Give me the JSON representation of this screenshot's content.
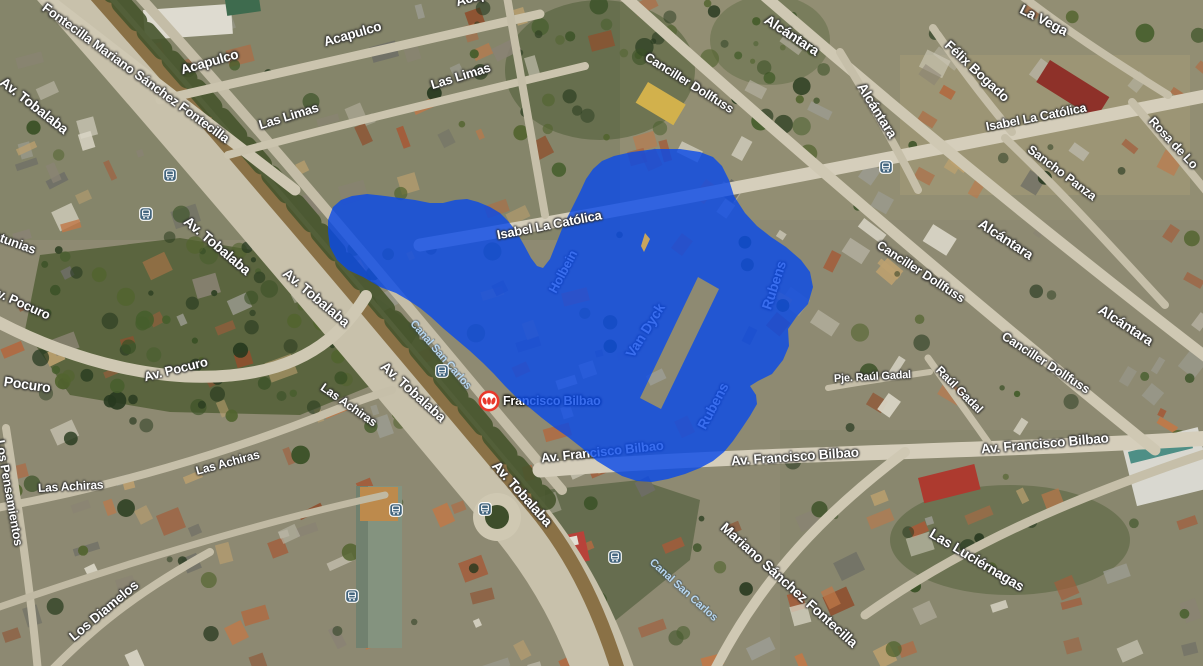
{
  "app": {
    "view": "satellite-map",
    "description": "Aerial map view with a blue highlighted area over the Francisco Bilbao / Av. Tobalaba district"
  },
  "colors": {
    "region_fill": "#0848ea",
    "region_opacity": 0.8,
    "gap_sliver_fill": "#c8a55e",
    "street_label": "#ffffff",
    "water_label": "#b7d6ef",
    "bus_icon_bg": "#43657e",
    "metro_red": "#e8392b",
    "ground_base": "#8e8a72",
    "road": "#d5cebb"
  },
  "metro_station": {
    "label": "Francisco Bilbao",
    "x": 489,
    "y": 401
  },
  "bus_stops": [
    {
      "x": 170,
      "y": 175
    },
    {
      "x": 146,
      "y": 214
    },
    {
      "x": 442,
      "y": 371
    },
    {
      "x": 396,
      "y": 510
    },
    {
      "x": 485,
      "y": 509
    },
    {
      "x": 615,
      "y": 557
    },
    {
      "x": 352,
      "y": 596
    },
    {
      "x": 886,
      "y": 167
    }
  ],
  "region_overlay": {
    "name": "highlighted-area",
    "fill": "#0848ea",
    "opacity": 0.8,
    "outer": [
      [
        328,
        232
      ],
      [
        328,
        220
      ],
      [
        333,
        207
      ],
      [
        341,
        200
      ],
      [
        352,
        196
      ],
      [
        367,
        194
      ],
      [
        385,
        196
      ],
      [
        400,
        198
      ],
      [
        415,
        200
      ],
      [
        430,
        203
      ],
      [
        443,
        203
      ],
      [
        455,
        200
      ],
      [
        467,
        199
      ],
      [
        478,
        202
      ],
      [
        490,
        207
      ],
      [
        500,
        213
      ],
      [
        508,
        221
      ],
      [
        516,
        231
      ],
      [
        524,
        245
      ],
      [
        531,
        258
      ],
      [
        537,
        266
      ],
      [
        543,
        268
      ],
      [
        550,
        259
      ],
      [
        556,
        244
      ],
      [
        562,
        229
      ],
      [
        568,
        216
      ],
      [
        574,
        204
      ],
      [
        580,
        192
      ],
      [
        586,
        179
      ],
      [
        593,
        169
      ],
      [
        602,
        161
      ],
      [
        614,
        156
      ],
      [
        632,
        152
      ],
      [
        655,
        149
      ],
      [
        680,
        149
      ],
      [
        700,
        152
      ],
      [
        713,
        157
      ],
      [
        722,
        166
      ],
      [
        729,
        180
      ],
      [
        734,
        196
      ],
      [
        745,
        213
      ],
      [
        757,
        226
      ],
      [
        771,
        237
      ],
      [
        786,
        247
      ],
      [
        801,
        260
      ],
      [
        810,
        272
      ],
      [
        813,
        287
      ],
      [
        808,
        304
      ],
      [
        797,
        316
      ],
      [
        788,
        329
      ],
      [
        789,
        346
      ],
      [
        783,
        360
      ],
      [
        772,
        374
      ],
      [
        758,
        381
      ],
      [
        750,
        386
      ],
      [
        756,
        395
      ],
      [
        757,
        404
      ],
      [
        750,
        416
      ],
      [
        742,
        428
      ],
      [
        733,
        441
      ],
      [
        724,
        452
      ],
      [
        713,
        461
      ],
      [
        700,
        468
      ],
      [
        685,
        474
      ],
      [
        668,
        479
      ],
      [
        652,
        482
      ],
      [
        637,
        481
      ],
      [
        622,
        476
      ],
      [
        610,
        469
      ],
      [
        597,
        461
      ],
      [
        582,
        448
      ],
      [
        568,
        437
      ],
      [
        555,
        428
      ],
      [
        542,
        418
      ],
      [
        530,
        408
      ],
      [
        517,
        398
      ],
      [
        505,
        386
      ],
      [
        494,
        374
      ],
      [
        483,
        363
      ],
      [
        470,
        351
      ],
      [
        457,
        340
      ],
      [
        444,
        329
      ],
      [
        431,
        317
      ],
      [
        420,
        308
      ],
      [
        408,
        300
      ],
      [
        396,
        293
      ],
      [
        380,
        287
      ],
      [
        363,
        277
      ],
      [
        348,
        270
      ],
      [
        337,
        260
      ],
      [
        330,
        247
      ]
    ],
    "hole": [
      [
        698,
        277
      ],
      [
        719,
        289
      ],
      [
        661,
        409
      ],
      [
        640,
        398
      ]
    ],
    "gap_sliver": [
      [
        645,
        233
      ],
      [
        650,
        239
      ],
      [
        644,
        252
      ],
      [
        641,
        246
      ]
    ]
  },
  "map_labels": [
    {
      "id": "fontecilla-top",
      "text": "Fontecilla Mariano Sánchez Fontecilla",
      "x": 44,
      "y": 6,
      "rot": 36,
      "fs": 13,
      "style": "street",
      "layer": "over"
    },
    {
      "id": "av-tobalaba-1",
      "text": "Av. Tobalaba",
      "x": 2,
      "y": 80,
      "rot": 38,
      "fs": 14,
      "style": "street",
      "layer": "over"
    },
    {
      "id": "acapulco-1",
      "text": "Acapulco",
      "x": 181,
      "y": 70,
      "rot": -16,
      "fs": 13.5,
      "style": "street",
      "layer": "over"
    },
    {
      "id": "acapulco-2",
      "text": "Acapulco",
      "x": 324,
      "y": 42,
      "rot": -16,
      "fs": 13.5,
      "style": "street",
      "layer": "over"
    },
    {
      "id": "acapulco-3",
      "text": "Acapulco",
      "x": 456,
      "y": 2,
      "rot": -16,
      "fs": 13.5,
      "style": "street",
      "layer": "over"
    },
    {
      "id": "las-limas-1",
      "text": "Las Limas",
      "x": 259,
      "y": 125,
      "rot": -17,
      "fs": 13,
      "style": "street",
      "layer": "over"
    },
    {
      "id": "las-limas-2",
      "text": "Las Limas",
      "x": 431,
      "y": 85,
      "rot": -17,
      "fs": 13,
      "style": "street",
      "layer": "over"
    },
    {
      "id": "canciller-dollfuss-1",
      "text": "Canciller Dollfuss",
      "x": 646,
      "y": 56,
      "rot": 32,
      "fs": 12.5,
      "style": "street",
      "layer": "over"
    },
    {
      "id": "alcantara-1",
      "text": "Alcántara",
      "x": 766,
      "y": 18,
      "rot": 33,
      "fs": 14,
      "style": "street",
      "layer": "over"
    },
    {
      "id": "alcantara-2",
      "text": "Alcántara",
      "x": 861,
      "y": 84,
      "rot": 58,
      "fs": 14,
      "style": "street",
      "layer": "over"
    },
    {
      "id": "la-vega",
      "text": "La Vega",
      "x": 1021,
      "y": 8,
      "rot": 27,
      "fs": 14,
      "style": "street",
      "layer": "over"
    },
    {
      "id": "felix-bogado",
      "text": "Félix Bogado",
      "x": 947,
      "y": 43,
      "rot": 43,
      "fs": 13.5,
      "style": "street",
      "layer": "over"
    },
    {
      "id": "isabel-la-catolica-1",
      "text": "Isabel La Católica",
      "x": 986,
      "y": 127,
      "rot": -11,
      "fs": 12.5,
      "style": "street",
      "layer": "over"
    },
    {
      "id": "sancho-panza",
      "text": "Sancho Panza",
      "x": 1029,
      "y": 148,
      "rot": 37,
      "fs": 12.5,
      "style": "street",
      "layer": "over"
    },
    {
      "id": "rosa-de-lo",
      "text": "Rosa de Lo",
      "x": 1151,
      "y": 119,
      "rot": 47,
      "fs": 12.5,
      "style": "street",
      "layer": "over"
    },
    {
      "id": "av-tobalaba-2",
      "text": "Av. Tobalaba",
      "x": 186,
      "y": 219,
      "rot": 40,
      "fs": 14,
      "style": "street",
      "layer": "over"
    },
    {
      "id": "av-tobalaba-3",
      "text": "Av. Tobalaba",
      "x": 285,
      "y": 271,
      "rot": 40,
      "fs": 14,
      "style": "street",
      "layer": "over"
    },
    {
      "id": "petunias",
      "text": "Petunias",
      "x": -14,
      "y": 232,
      "rot": 20,
      "fs": 13,
      "style": "street",
      "layer": "over"
    },
    {
      "id": "av-pocuro-1",
      "text": "Av. Pocuro",
      "x": -10,
      "y": 289,
      "rot": 24,
      "fs": 13,
      "style": "street",
      "layer": "over"
    },
    {
      "id": "pocuro",
      "text": "Pocuro",
      "x": 4,
      "y": 381,
      "rot": 8,
      "fs": 14,
      "style": "street",
      "layer": "over"
    },
    {
      "id": "av-pocuro-2",
      "text": "Av. Pocuro",
      "x": 144,
      "y": 377,
      "rot": -14,
      "fs": 13,
      "style": "street",
      "layer": "over"
    },
    {
      "id": "las-achiras-1",
      "text": "Las Achiras",
      "x": 322,
      "y": 386,
      "rot": 35,
      "fs": 12,
      "style": "street",
      "layer": "over"
    },
    {
      "id": "av-tobalaba-4",
      "text": "Av. Tobalaba",
      "x": 383,
      "y": 364,
      "rot": 42,
      "fs": 14,
      "style": "street",
      "layer": "over"
    },
    {
      "id": "av-tobalaba-5",
      "text": "Av. Tobalaba",
      "x": 495,
      "y": 463,
      "rot": 48,
      "fs": 14,
      "style": "street",
      "layer": "over"
    },
    {
      "id": "las-achiras-2",
      "text": "Las Achiras",
      "x": 196,
      "y": 471,
      "rot": -15,
      "fs": 12,
      "style": "street",
      "layer": "over"
    },
    {
      "id": "las-achiras-3",
      "text": "Las Achiras",
      "x": 38,
      "y": 488,
      "rot": -3,
      "fs": 12,
      "style": "street",
      "layer": "over"
    },
    {
      "id": "los-pensamientos",
      "text": "Los Pensamientos",
      "x": 0,
      "y": 440,
      "rot": 80,
      "fs": 12.5,
      "style": "street",
      "layer": "over"
    },
    {
      "id": "los-diamelos",
      "text": "Los Diamelos",
      "x": 71,
      "y": 638,
      "rot": -40,
      "fs": 13.5,
      "style": "street",
      "layer": "over"
    },
    {
      "id": "canal-san-carlos-1",
      "text": "Canal San Carlos",
      "x": 412,
      "y": 322,
      "rot": 49,
      "fs": 11,
      "style": "water",
      "layer": "over"
    },
    {
      "id": "canal-san-carlos-2",
      "text": "Canal San Carlos",
      "x": 651,
      "y": 561,
      "rot": 42,
      "fs": 11,
      "style": "water",
      "layer": "over"
    },
    {
      "id": "isabel-la-catolica-2",
      "text": "Isabel La Católica",
      "x": 497,
      "y": 235,
      "rot": -11,
      "fs": 13,
      "style": "street",
      "layer": "over"
    },
    {
      "id": "holbein",
      "text": "Holbein",
      "x": 552,
      "y": 292,
      "rot": -62,
      "fs": 13,
      "style": "street",
      "layer": "under"
    },
    {
      "id": "van-dyck",
      "text": "Van Dyck",
      "x": 629,
      "y": 356,
      "rot": -58,
      "fs": 14,
      "style": "street",
      "layer": "under"
    },
    {
      "id": "rubens-1",
      "text": "Rubens",
      "x": 766,
      "y": 309,
      "rot": -72,
      "fs": 14,
      "style": "street",
      "layer": "under"
    },
    {
      "id": "rubens-2",
      "text": "Rubens",
      "x": 701,
      "y": 428,
      "rot": -62,
      "fs": 14,
      "style": "street",
      "layer": "under"
    },
    {
      "id": "av-francisco-bilbao-0",
      "text": "Av. Francisco Bilbao",
      "x": 541,
      "y": 458,
      "rot": -6,
      "fs": 13,
      "style": "street",
      "layer": "under"
    },
    {
      "id": "francisco-bilbao-station",
      "text": "Francisco Bilbao",
      "x": 503,
      "y": 401,
      "rot": 0,
      "fs": 12.5,
      "style": "station",
      "layer": "under"
    },
    {
      "id": "av-francisco-bilbao-1",
      "text": "Av. Francisco Bilbao",
      "x": 731,
      "y": 461,
      "rot": -4,
      "fs": 13.5,
      "style": "street",
      "layer": "over"
    },
    {
      "id": "av-francisco-bilbao-2",
      "text": "Av. Francisco Bilbao",
      "x": 981,
      "y": 449,
      "rot": -5,
      "fs": 13.5,
      "style": "street",
      "layer": "over"
    },
    {
      "id": "pje-raul-gadal",
      "text": "Pje. Raúl Gadal",
      "x": 834,
      "y": 379,
      "rot": -3,
      "fs": 11,
      "style": "street",
      "layer": "over"
    },
    {
      "id": "raul-gadal",
      "text": "Raúl Gadal",
      "x": 938,
      "y": 368,
      "rot": 45,
      "fs": 12,
      "style": "street",
      "layer": "over"
    },
    {
      "id": "canciller-dollfuss-2",
      "text": "Canciller Dollfuss",
      "x": 878,
      "y": 244,
      "rot": 33,
      "fs": 12.5,
      "style": "street",
      "layer": "over"
    },
    {
      "id": "canciller-dollfuss-3",
      "text": "Canciller Dollfuss",
      "x": 1003,
      "y": 335,
      "rot": 33,
      "fs": 12.5,
      "style": "street",
      "layer": "over"
    },
    {
      "id": "alcantara-3",
      "text": "Alcántara",
      "x": 980,
      "y": 222,
      "rot": 33,
      "fs": 14,
      "style": "street",
      "layer": "over"
    },
    {
      "id": "alcantara-4",
      "text": "Alcántara",
      "x": 1100,
      "y": 308,
      "rot": 33,
      "fs": 14,
      "style": "street",
      "layer": "over"
    },
    {
      "id": "las-luciernagas",
      "text": "Las Luciérnagas",
      "x": 931,
      "y": 532,
      "rot": 31,
      "fs": 14,
      "style": "street",
      "layer": "over"
    },
    {
      "id": "mariano-sanchez-fontecilla",
      "text": "Mariano Sánchez Fontecilla",
      "x": 723,
      "y": 525,
      "rot": 42,
      "fs": 14,
      "style": "street",
      "layer": "over"
    }
  ]
}
